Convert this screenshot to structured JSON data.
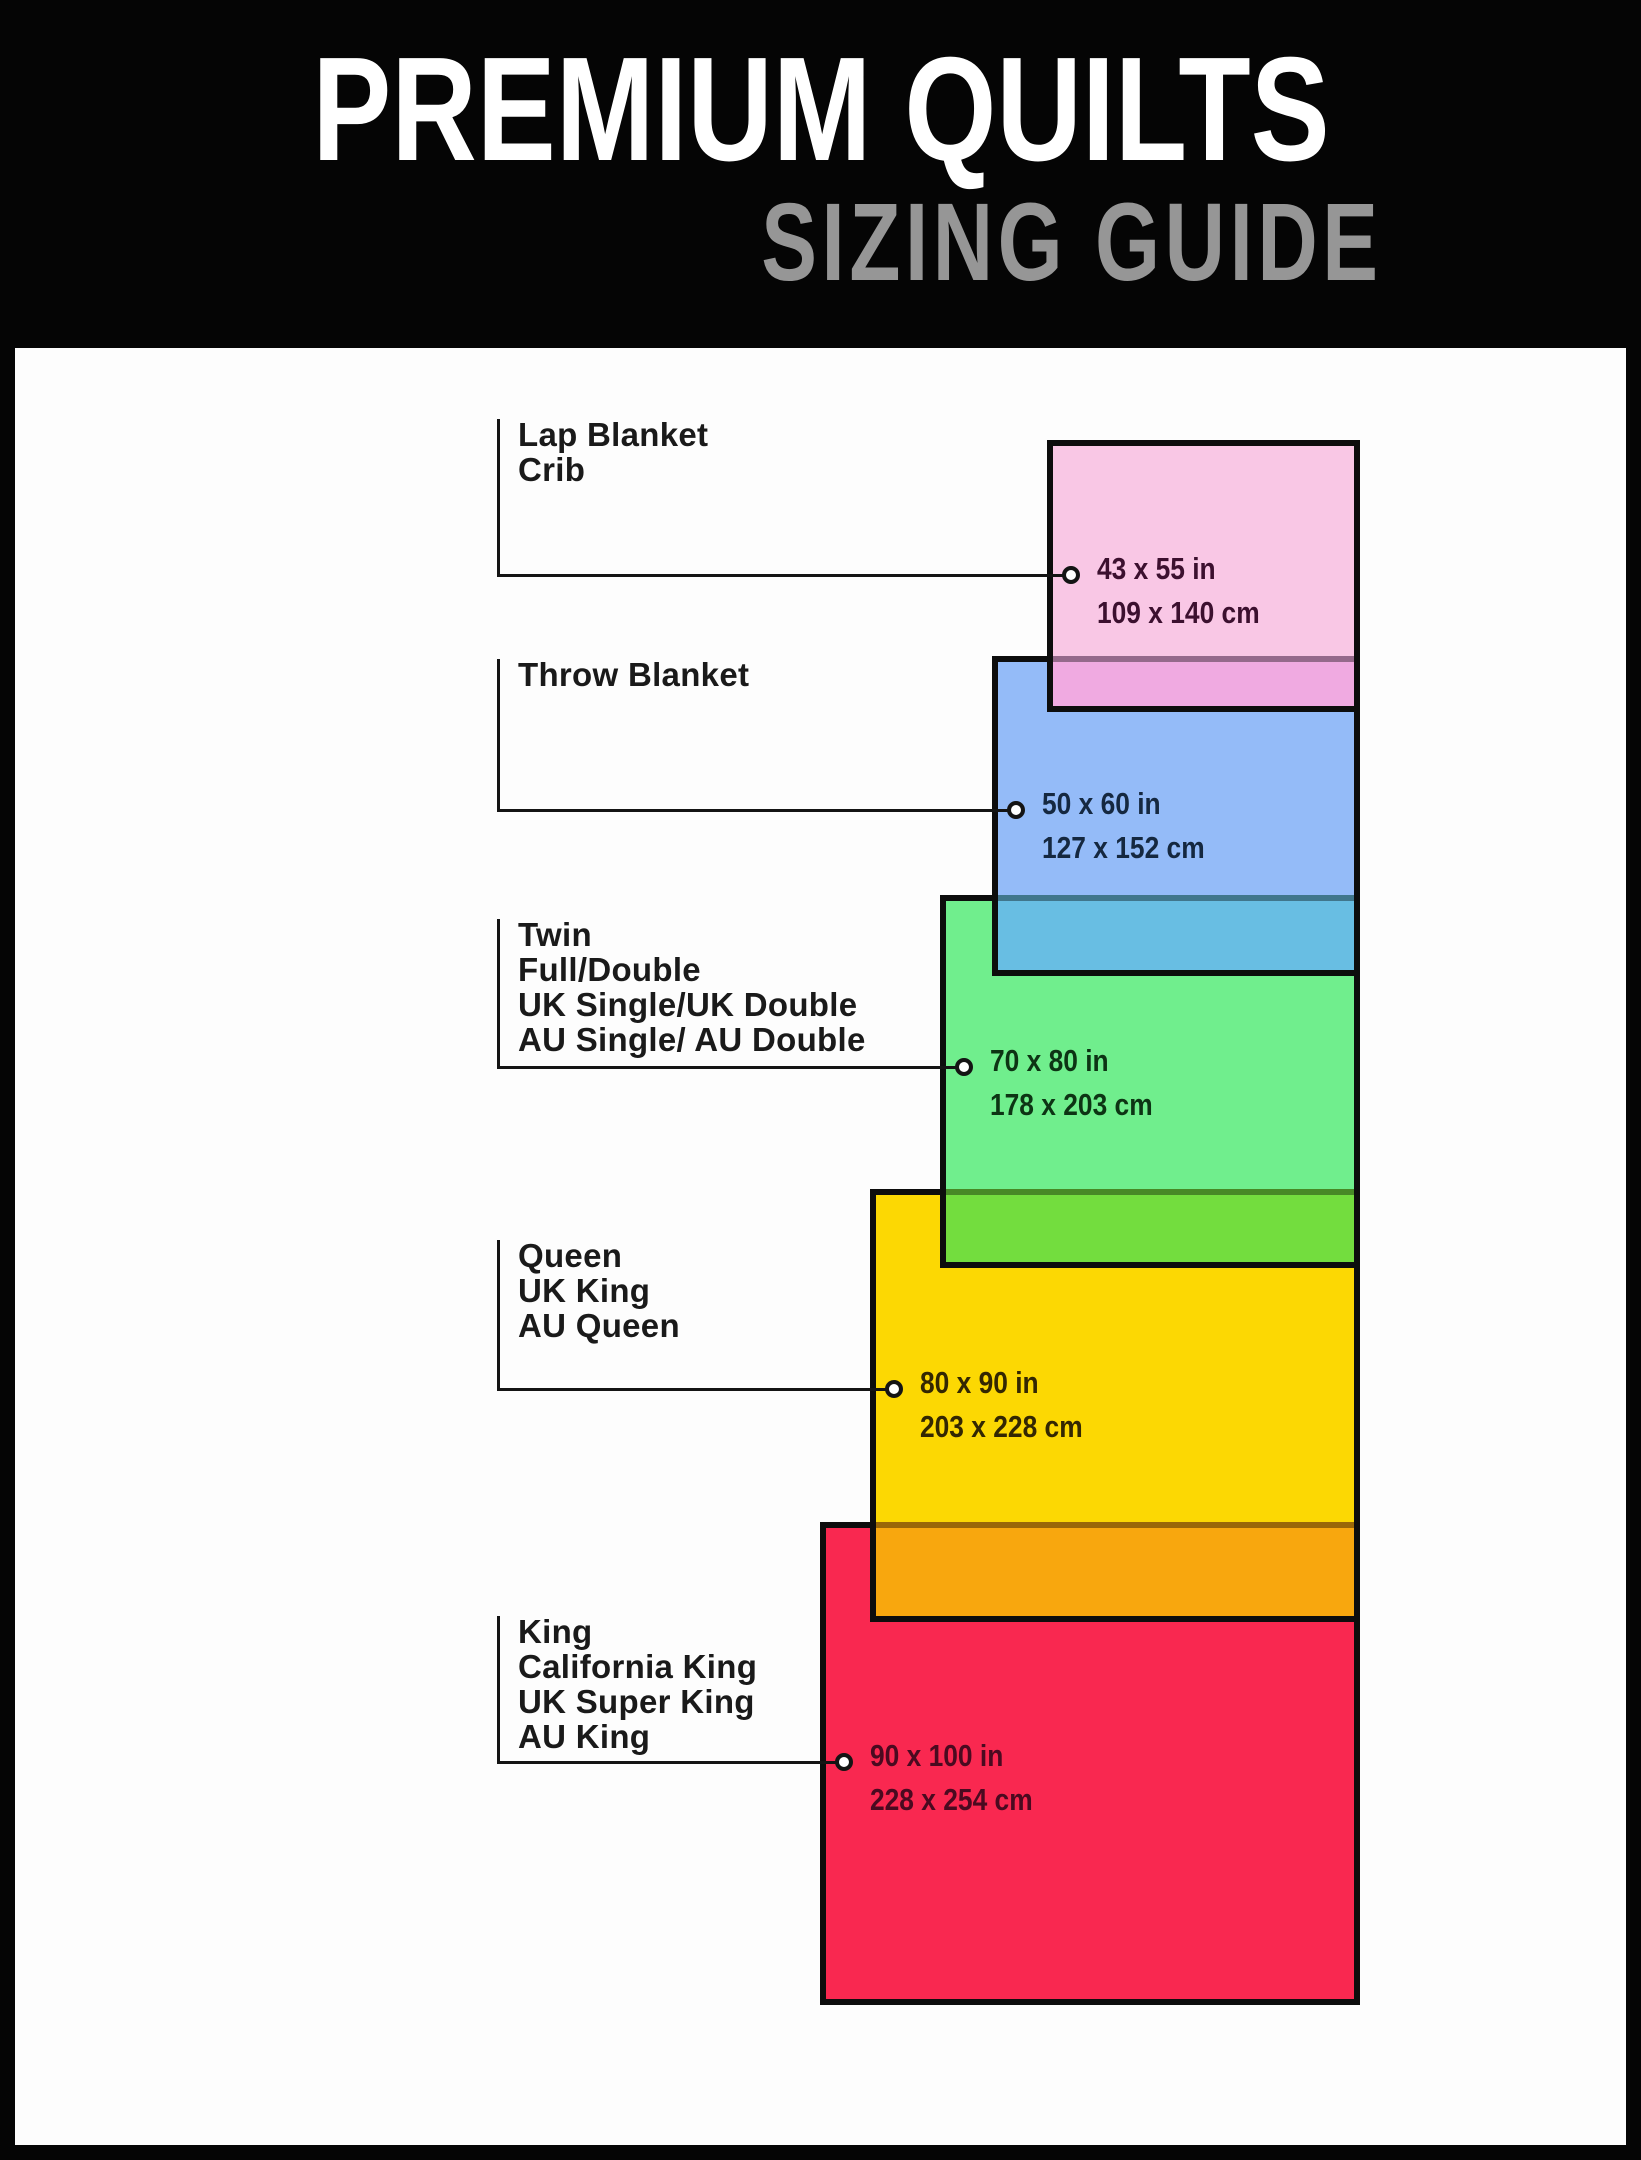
{
  "header": {
    "title": "PREMIUM QUILTS",
    "subtitle": "SIZING GUIDE",
    "bg_color": "#050505",
    "title_color": "#ffffff",
    "subtitle_color": "#969696"
  },
  "quilts": [
    {
      "id": "lap-crib",
      "labels": [
        "Lap Blanket",
        "Crib"
      ],
      "size_in": "43 x 55 in",
      "size_cm": "109 x 140 cm",
      "fill": "#f9c7e5",
      "overlap": "#f0aae1",
      "text_color": "#3c102f"
    },
    {
      "id": "throw",
      "labels": [
        "Throw Blanket"
      ],
      "size_in": "50 x 60 in",
      "size_cm": "127 x 152 cm",
      "fill": "#94bbf8",
      "overlap": "#68bee3",
      "text_color": "#152840"
    },
    {
      "id": "twin",
      "labels": [
        "Twin",
        "Full/Double",
        "UK Single/UK Double",
        "AU Single/ AU Double"
      ],
      "size_in": "70 x 80 in",
      "size_cm": "178 x 203 cm",
      "fill": "#70ee8d",
      "overlap": "#73dd3e",
      "text_color": "#0d3414"
    },
    {
      "id": "queen",
      "labels": [
        "Queen",
        "UK King",
        "AU Queen"
      ],
      "size_in": "80 x 90 in",
      "size_cm": "203 x 228 cm",
      "fill": "#fcd803",
      "overlap": "#f8a70e",
      "text_color": "#332702"
    },
    {
      "id": "king",
      "labels": [
        "King",
        "California King",
        "UK Super King",
        "AU King"
      ],
      "size_in": "90 x 100 in",
      "size_cm": "228 x 254 cm",
      "fill": "#f92850",
      "overlap": null,
      "text_color": "#4a0a20"
    }
  ],
  "style": {
    "line_color": "#141414",
    "rect_border_color": "#0d0d0d",
    "panel_color": "#fdfdfd"
  }
}
